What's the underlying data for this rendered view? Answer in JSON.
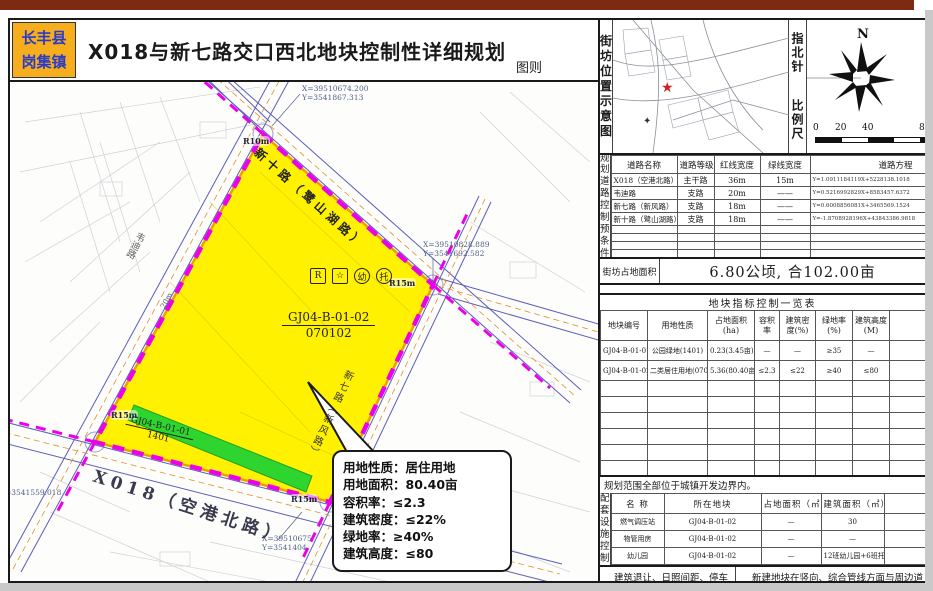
{
  "header": {
    "county": "长丰县",
    "town": "岗集镇",
    "title": "X018与新七路交口西北地块控制性详细规划",
    "sheet_label": "图则"
  },
  "right_panel": {
    "location_map_label": "街坊位置示意图",
    "compass_label": "指北针",
    "scale_label": "比例尺",
    "north": "N",
    "scale_ticks": [
      "0",
      "20",
      "40",
      "80"
    ],
    "road_table": {
      "side_label": "规划道路控制预条件",
      "headers": [
        "道路名称",
        "道路等级",
        "红线宽度",
        "绿线宽度",
        "道路方程"
      ],
      "rows": [
        [
          "X018（空港北路）",
          "主干路",
          "36m",
          "15m",
          "Y=1.0911184119X+5228138.1018"
        ],
        [
          "韦迪路",
          "支路",
          "20m",
          "——",
          "Y=0.5216992829X+8583457.6372"
        ],
        [
          "新七路（新风路）",
          "支路",
          "18m",
          "——",
          "Y=0.6008856081X+3465569.1524"
        ],
        [
          "新十路（鹭山湖路）",
          "支路",
          "18m",
          "——",
          "Y=-1.8708928196X+43843386.9818"
        ]
      ]
    },
    "block_area": {
      "label": "街坊占地面积",
      "value": "6.80公顷, 合102.00亩"
    },
    "index_table": {
      "title": "地块指标控制一览表",
      "headers": [
        "地块编号",
        "用地性质",
        "占地面积(ha)",
        "容积率",
        "建筑密度(%)",
        "绿地率(%)",
        "建筑高度(M)",
        "备注"
      ],
      "rows": [
        [
          "GJ04-B-01-01",
          "公园绿地(1401)",
          "0.23(3.45亩)",
          "—",
          "—",
          "≥35",
          "—",
          ""
        ],
        [
          "GJ04-B-01-02",
          "二类居住用地(070102)",
          "5.36(80.40亩)",
          "≤2.3",
          "≤22",
          "≥40",
          "≤80",
          ""
        ]
      ]
    },
    "boundary_note": "规划范围全部位于城镇开发边界内。",
    "facility_table": {
      "side_label": "配套设施控制",
      "headers": [
        "名  称",
        "所在地块",
        "占地面积（㎡）",
        "建筑面积（㎡）",
        "备注"
      ],
      "rows": [
        [
          "燃气调压站",
          "GJ04-B-01-02",
          "—",
          "30",
          "随"
        ],
        [
          "物管用房",
          "GJ04-B-01-02",
          "—",
          "—",
          "—"
        ],
        [
          "幼儿园",
          "GJ04-B-01-02",
          "—",
          "12班幼儿园+6班托所",
          "随"
        ]
      ]
    },
    "bottom_notes": {
      "left": "建筑退让、日照间距、停车位配置 等",
      "right": "新建地块在竖向、综合管线方面与周边道"
    }
  },
  "map": {
    "coords": {
      "c1x": "X=39510674.200",
      "c1y": "Y=3541867.313",
      "c2x": "X=39510828.889",
      "c2y": "Y=3541692.582",
      "c3x": "X=39510675",
      "c3y": "Y=3541404",
      "c4y": "Y=3541559.018"
    },
    "radius_labels": {
      "r1": "R10m",
      "r2": "R15m",
      "r3": "R15m",
      "r4": "R15m"
    },
    "width_label": "20m",
    "road_names": {
      "northeast": "新十路（鹭山湖路）",
      "southeast": "新七路（新风路）",
      "west": "韦迪路",
      "south": "X018（空港北路）"
    },
    "parcel_main": {
      "code": "GJ04-B-01-02",
      "use_code": "070102"
    },
    "parcel_green": {
      "code": "GJ04-B-01-01",
      "use_code": "1401"
    },
    "facility_icons": {
      "i1": "R",
      "i2": "☆",
      "i3": "幼",
      "i4": "托"
    },
    "callout": {
      "l1": "用地性质：居住用地",
      "l2": "用地面积：80.40亩",
      "l3": "容积率：≤2.3",
      "l4": "建筑密度：≤22%",
      "l5": "绿地率：≥40%",
      "l6": "建筑高度：≤80"
    },
    "colors": {
      "parcel": "#fff100",
      "green": "#2ed52e",
      "boundary": "#ea00ea",
      "road": "#4040b0"
    }
  }
}
